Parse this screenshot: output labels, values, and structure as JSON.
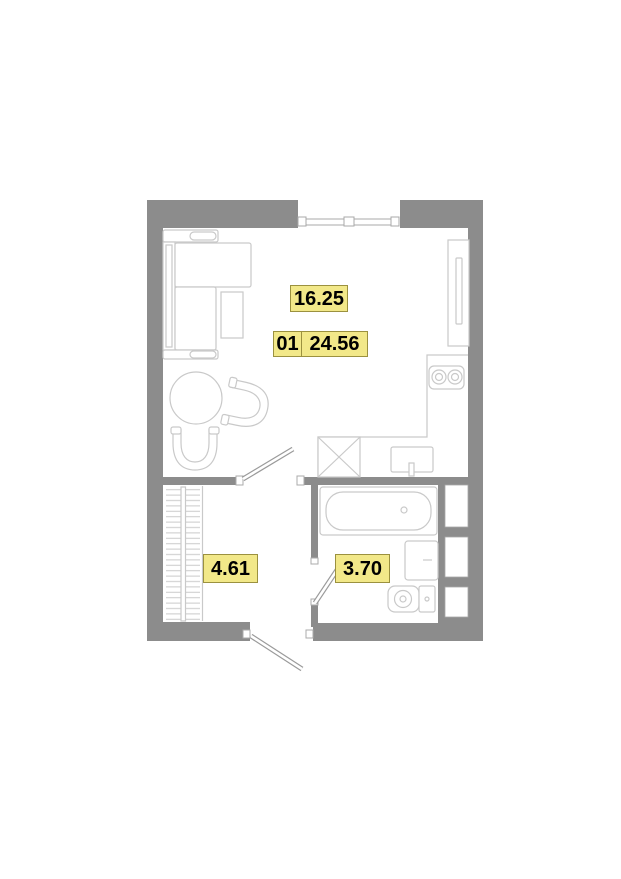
{
  "floor_plan": {
    "unit_number": "01",
    "total_area": "24.56",
    "rooms": {
      "living": {
        "area": "16.25"
      },
      "hallway": {
        "area": "4.61"
      },
      "bathroom": {
        "area": "3.70"
      }
    },
    "colors": {
      "wall": "#8c8c8c",
      "furniture-line": "#c9c9c9",
      "door-line": "#9a9a9a",
      "label-bg": "#f2e889",
      "label-border": "#9b913f",
      "label-text": "#000000"
    }
  }
}
